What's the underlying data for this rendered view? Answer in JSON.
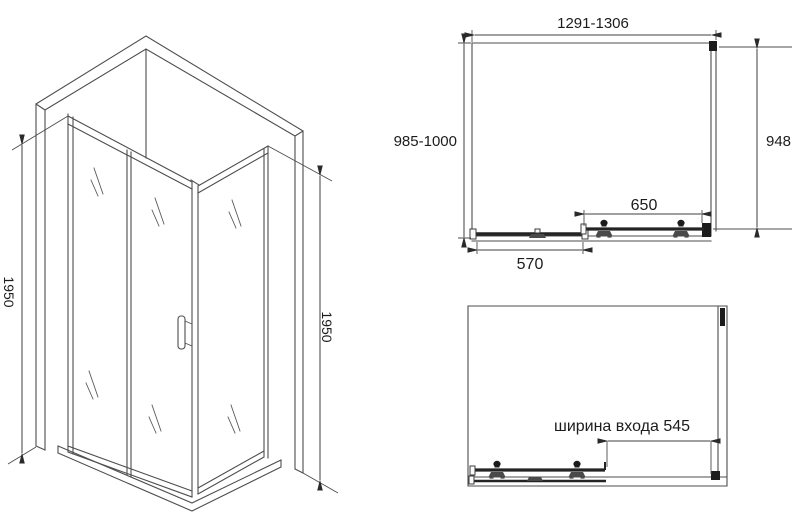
{
  "colors": {
    "line": "#4d4d4d",
    "dark_fill": "#1c1c1c",
    "text": "#1c1c1c",
    "background": "#ffffff"
  },
  "iso_view": {
    "height_left": "1950",
    "height_right": "1950"
  },
  "plan_view": {
    "overall_width": "1291-1306",
    "depth": "985-1000",
    "side_panel": "948",
    "door_panel": "650",
    "fixed_panel": "570"
  },
  "open_view": {
    "entry_width": "ширина входа 545"
  }
}
